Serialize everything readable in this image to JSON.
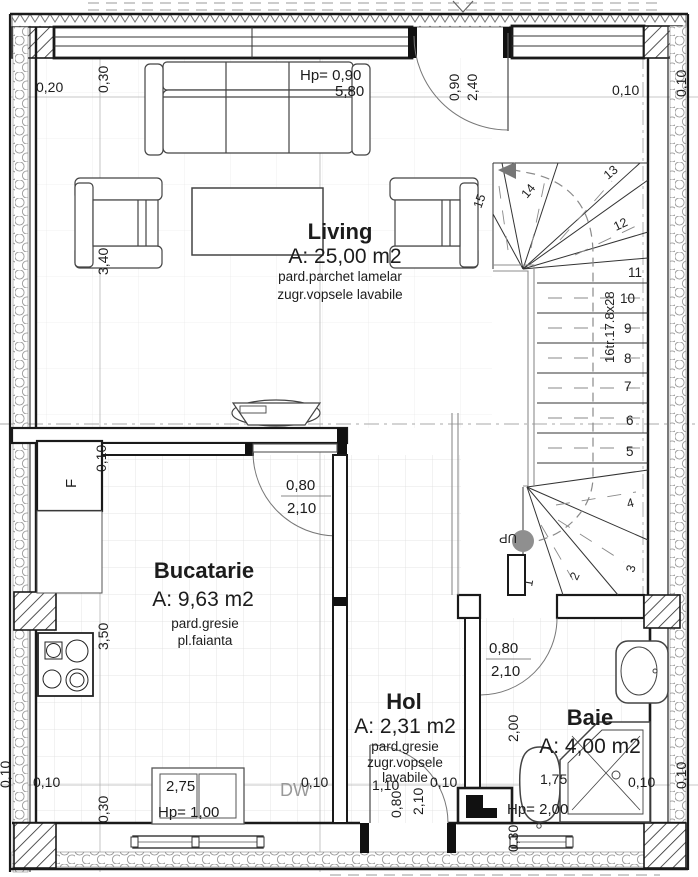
{
  "rooms": {
    "living": {
      "name": "Living",
      "area": "A: 25,00 m2",
      "finish1": "pard.parchet lamelar",
      "finish2": "zugr.vopsele lavabile"
    },
    "bucatarie": {
      "name": "Bucatarie",
      "area": "A: 9,63 m2",
      "finish1": "pard.gresie",
      "finish2": "pl.faianta"
    },
    "hol": {
      "name": "Hol",
      "area": "A: 2,31 m2",
      "finish1": "pard.gresie",
      "finish2": "zugr.vopsele",
      "finish3": "lavabile"
    },
    "baie": {
      "name": "Baie",
      "area": "A: 4,00 m2"
    }
  },
  "stairs": {
    "label": "16tr.17.8x28",
    "up": "UP",
    "steps": [
      "1",
      "2",
      "3",
      "4",
      "5",
      "6",
      "7",
      "8",
      "9",
      "10",
      "11",
      "12",
      "13",
      "14",
      "15"
    ]
  },
  "doors": {
    "entry_top": {
      "width": "0,90",
      "height": "2,40"
    },
    "kitchen": {
      "width": "0,80",
      "height": "2,10"
    },
    "bathroom": {
      "width": "0,80",
      "height": "2,10"
    },
    "entry_bottom": {
      "width": "0,80",
      "height": "2,10"
    }
  },
  "windows": {
    "living": {
      "hp": "Hp= 0,90",
      "width": "5,80"
    },
    "kitchen": {
      "width": "2,75",
      "hp": "Hp= 1,00"
    },
    "bathroom": {
      "hp": "Hp= 2,00"
    }
  },
  "dims": {
    "d020": "0,20",
    "d030": "0,30",
    "d010": "0,10",
    "d340": "3,40",
    "d350": "3,50",
    "d110": "1,10",
    "d175": "1,75",
    "d200": "2,00"
  },
  "annotations": {
    "dw": "DW",
    "fridge": "F"
  },
  "colors": {
    "wall": "#1a1a1a",
    "dim_line": "#b5b5b5",
    "walkline": "#8a8a8a",
    "up_dot": "#8f8f8f"
  }
}
